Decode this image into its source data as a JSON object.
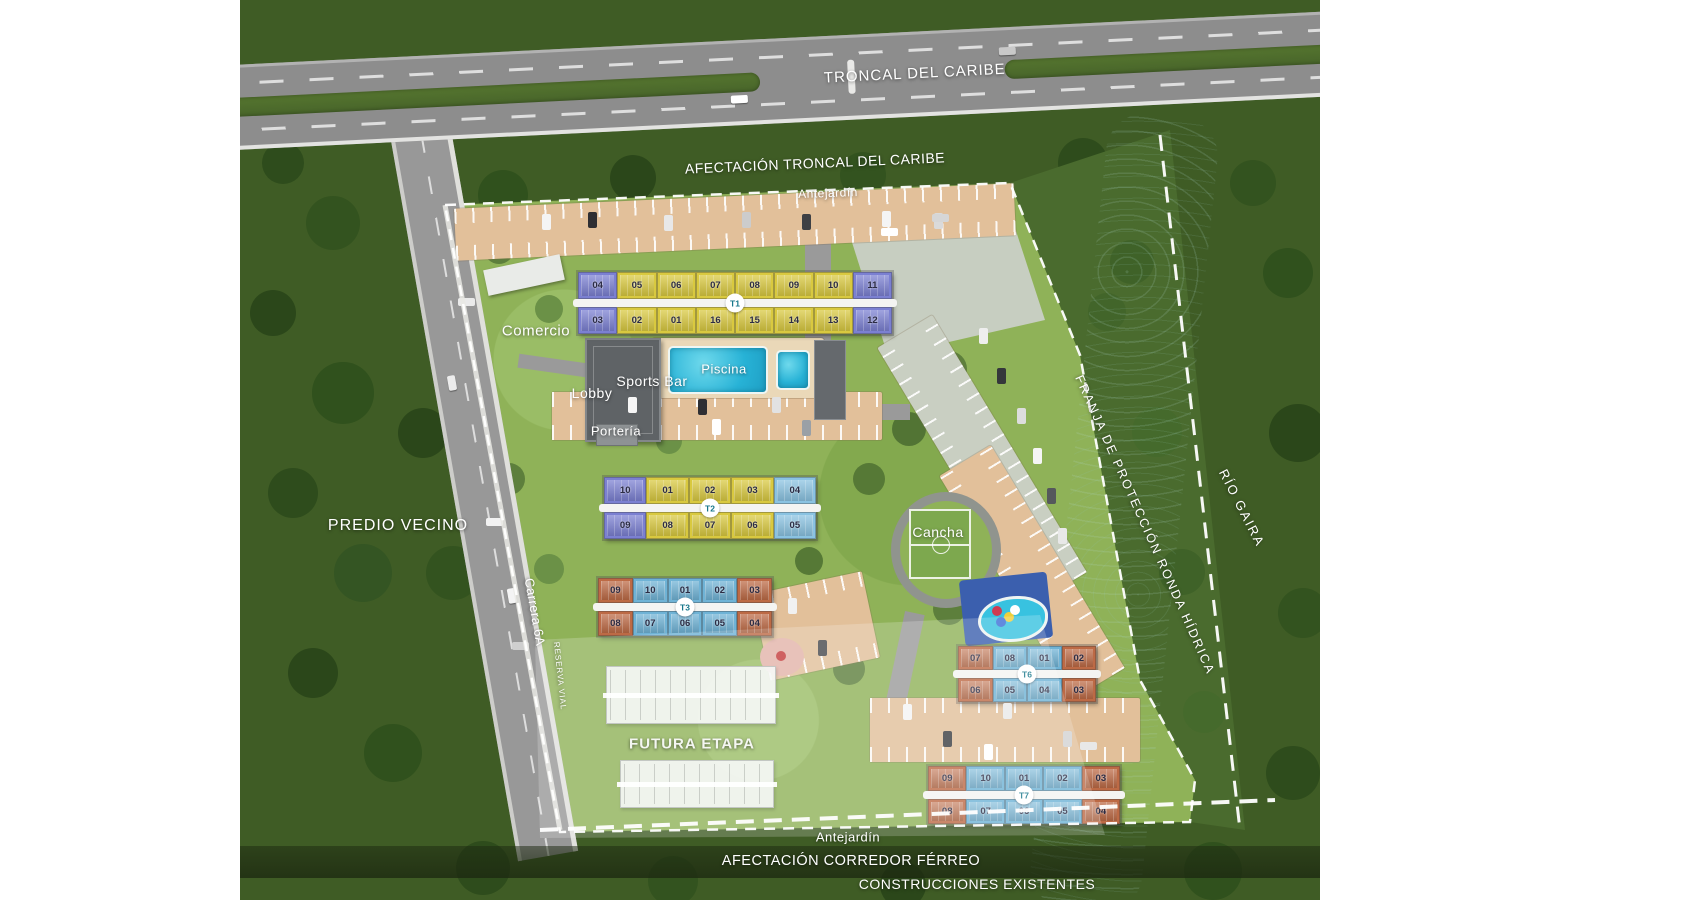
{
  "roads": {
    "highway": "TRONCAL DEL CARIBE",
    "street": "Carrera 6A",
    "reserve": "RESERVA VIAL"
  },
  "zones": {
    "afectacion_troncal": "AFECTACIÓN TRONCAL DEL CARIBE",
    "antejardin_top": "Antejardín",
    "antejardin_bottom": "Antejardín",
    "predio_vecino": "PREDIO VECINO",
    "futura_etapa": "FUTURA ETAPA",
    "franja_proteccion": "FRANJA DE PROTECCIÓN RONDA HÍDRICA",
    "rio": "RÍO GAIRA",
    "corredor_ferreo": "AFECTACIÓN CORREDOR FÉRREO",
    "construcciones": "CONSTRUCCIONES EXISTENTES"
  },
  "amenities": {
    "comercio": "Comercio",
    "lobby": "Lobby",
    "sports_bar": "Sports Bar",
    "porteria": "Portería",
    "piscina": "Piscina",
    "cancha": "Cancha"
  },
  "buildings": [
    {
      "id": "T1",
      "label": "T1",
      "top": [
        "04",
        "05",
        "06",
        "07",
        "08",
        "09",
        "10",
        "11"
      ],
      "bottom": [
        "03",
        "02",
        "01",
        "16",
        "15",
        "14",
        "13",
        "12"
      ],
      "top_colors": [
        "purple",
        "yellow",
        "yellow",
        "yellow",
        "yellow",
        "yellow",
        "yellow",
        "purple"
      ],
      "bottom_colors": [
        "purple",
        "yellow",
        "yellow",
        "yellow",
        "yellow",
        "yellow",
        "yellow",
        "purple"
      ]
    },
    {
      "id": "T2",
      "label": "T2",
      "top": [
        "10",
        "01",
        "02",
        "03",
        "04"
      ],
      "bottom": [
        "09",
        "08",
        "07",
        "06",
        "05"
      ],
      "top_colors": [
        "purple",
        "yellow",
        "yellow",
        "yellow",
        "skyblue"
      ],
      "bottom_colors": [
        "purple",
        "yellow",
        "yellow",
        "yellow",
        "skyblue"
      ]
    },
    {
      "id": "T3",
      "label": "T3",
      "top": [
        "09",
        "10",
        "01",
        "02",
        "03"
      ],
      "bottom": [
        "08",
        "07",
        "06",
        "05",
        "04"
      ],
      "top_colors": [
        "orange",
        "blue",
        "blue",
        "blue",
        "orange"
      ],
      "bottom_colors": [
        "orange",
        "blue",
        "blue",
        "blue",
        "orange"
      ]
    },
    {
      "id": "T6",
      "label": "T6",
      "top": [
        "07",
        "08",
        "01",
        "02"
      ],
      "bottom": [
        "06",
        "05",
        "04",
        "03"
      ],
      "top_colors": [
        "orange",
        "blue",
        "blue",
        "orange"
      ],
      "bottom_colors": [
        "orange",
        "blue",
        "blue",
        "orange"
      ]
    },
    {
      "id": "T7",
      "label": "T7",
      "top": [
        "09",
        "10",
        "01",
        "02",
        "03"
      ],
      "bottom": [
        "08",
        "07",
        "06",
        "05",
        "04"
      ],
      "top_colors": [
        "orange",
        "blue",
        "blue",
        "blue",
        "orange"
      ],
      "bottom_colors": [
        "orange",
        "blue",
        "blue",
        "blue",
        "orange"
      ]
    }
  ],
  "palette": {
    "unit_yellow": "#d9c93f",
    "unit_purple": "#7b80d2",
    "unit_blue": "#6fb3d6",
    "unit_skyblue": "#8ac3e2",
    "unit_orange": "#bd6a45",
    "pool_water": "#27b2d6",
    "river_water": "#1d3a33",
    "forest_green": "#3f5c25",
    "site_green": "#8fb258",
    "road_gray": "#8d8d8d",
    "parking_beige": "#e2c09a",
    "boundary_white": "#ffffff"
  }
}
